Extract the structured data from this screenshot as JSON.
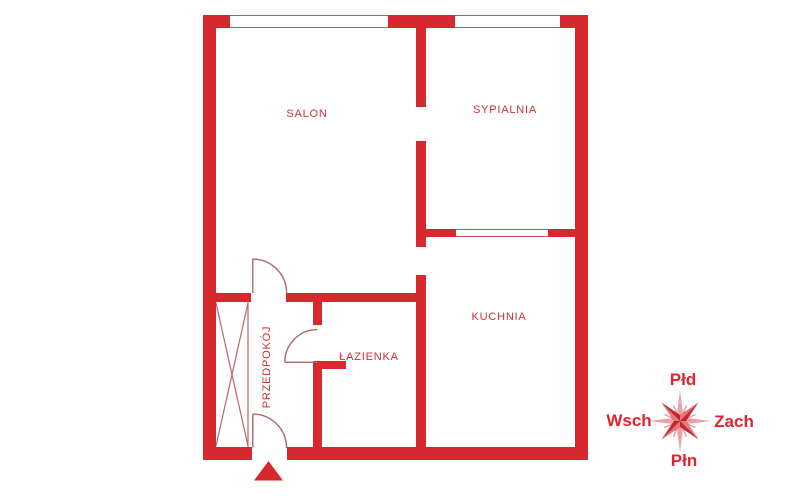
{
  "plan": {
    "rooms": {
      "salon": "SALON",
      "sypialnia": "SYPIALNIA",
      "kuchnia": "KUCHNIA",
      "lazienka": "ŁAZIENKA",
      "przedpokoj": "PRZEDPOKÓJ"
    },
    "features": {
      "windows": [
        "window-salon-top",
        "window-sypialnia-top",
        "window-internal-sypialnia-kuchnia"
      ],
      "doors": [
        "door-salon",
        "door-lazienka",
        "door-entrance"
      ],
      "entrance_marker": "triangle-up",
      "wardrobe_hatch": "crossed-diagonals"
    }
  },
  "compass": {
    "top": "Płd",
    "left": "Wsch",
    "right": "Zach",
    "bottom": "Płn"
  },
  "colors": {
    "wall": "#d7282e",
    "room_label": "#cd2f35",
    "compass_label": "#e3232b",
    "star_dark": "#c1272d",
    "star_mid": "#e2797e",
    "star_light": "#eaa2a6",
    "thin_line": "#a76a6e",
    "hatch_line": "#c06468",
    "background": "#ffffff"
  }
}
